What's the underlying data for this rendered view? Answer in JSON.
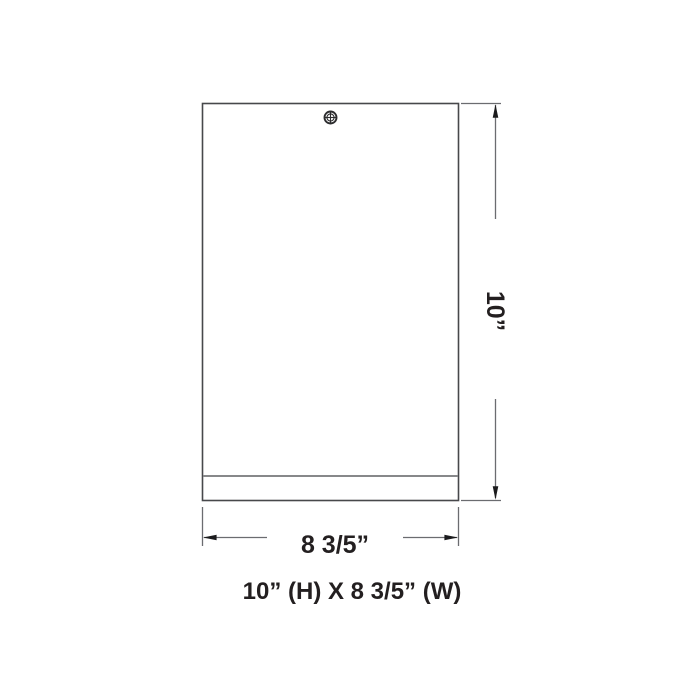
{
  "drawing": {
    "title": "fixture front elevation",
    "fixture": {
      "shape": "rectangle",
      "detail_icons": [
        "screw-icon"
      ]
    },
    "dimensions": {
      "height": {
        "label": "10”",
        "orientation": "vertical",
        "arrows": [
          "arrow-up-icon",
          "arrow-down-icon"
        ]
      },
      "width": {
        "label": "8 3/5”",
        "orientation": "horizontal",
        "arrows": [
          "arrow-left-icon",
          "arrow-right-icon"
        ]
      }
    },
    "caption": {
      "text": "10” (H) X 8 3/5” (W)"
    },
    "colors": {
      "background": "#ffffff",
      "outline": "#47484b",
      "trim_line": "#87888a",
      "dimension_line": "#6b6c70",
      "arrow": "#1b1b1d",
      "text": "#231f20"
    }
  }
}
